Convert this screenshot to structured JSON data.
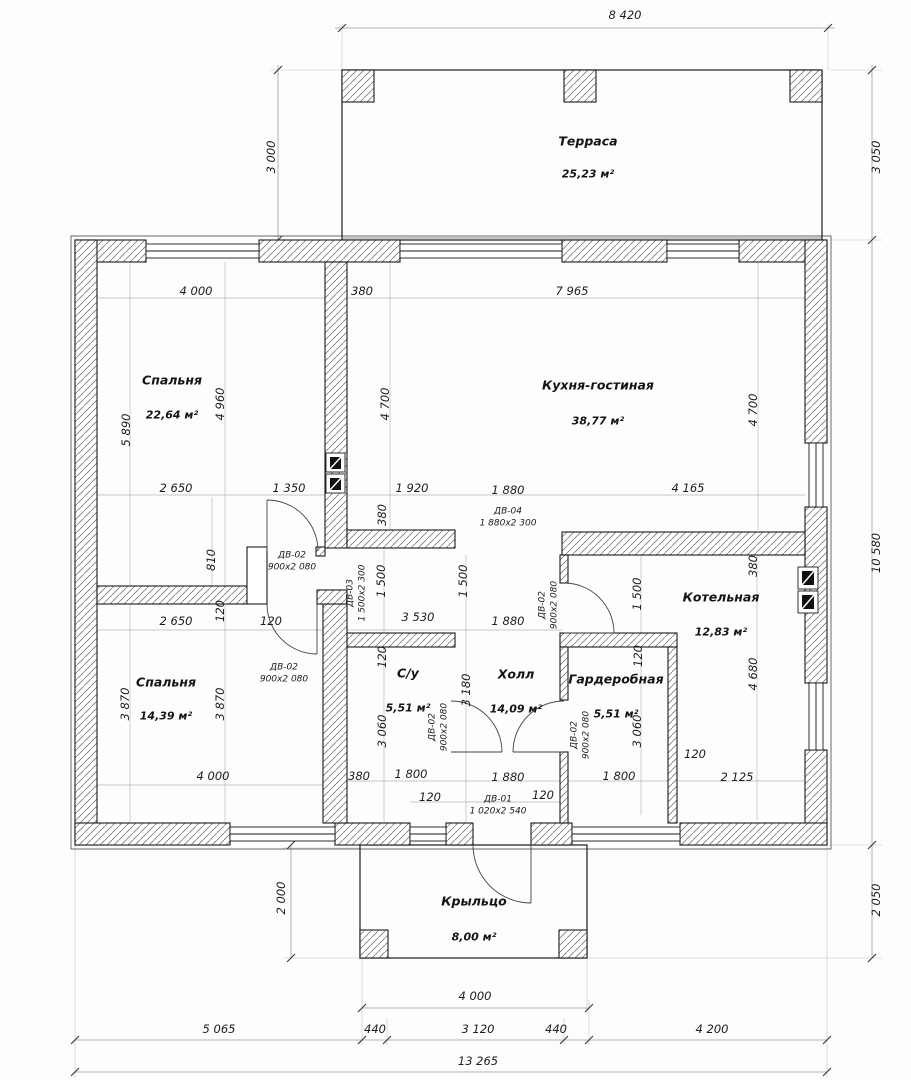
{
  "title": "Floor plan",
  "rooms": [
    {
      "id": "terrace",
      "name": "Терраса",
      "area": "25,23 м²",
      "x": 588,
      "ny": 141,
      "ay": 174
    },
    {
      "id": "bedroom-1",
      "name": "Спальня",
      "area": "22,64 м²",
      "x": 172,
      "ny": 380,
      "ay": 415
    },
    {
      "id": "kitchen",
      "name": "Кухня-гостиная",
      "area": "38,77 м²",
      "x": 598,
      "ny": 385,
      "ay": 421
    },
    {
      "id": "bedroom-2",
      "name": "Спальня",
      "area": "14,39 м²",
      "x": 166,
      "ny": 682,
      "ay": 716
    },
    {
      "id": "bathroom",
      "name": "С/у",
      "area": "5,51 м²",
      "x": 408,
      "ny": 673,
      "ay": 708
    },
    {
      "id": "hall",
      "name": "Холл",
      "area": "14,09 м²",
      "x": 516,
      "ny": 674,
      "ay": 709
    },
    {
      "id": "wardrobe",
      "name": "Гардеробная",
      "area": "5,51 м²",
      "x": 616,
      "ny": 679,
      "ay": 714
    },
    {
      "id": "boiler",
      "name": "Котельная",
      "area": "12,83 м²",
      "x": 721,
      "ny": 597,
      "ay": 632
    },
    {
      "id": "porch",
      "name": "Крыльцо",
      "area": "8,00 м²",
      "x": 474,
      "ny": 901,
      "ay": 937
    }
  ],
  "dims": [
    {
      "t": "8 420",
      "x": 625,
      "y": 15,
      "v": false
    },
    {
      "t": "3 050",
      "x": 876,
      "y": 157,
      "v": true
    },
    {
      "t": "3 000",
      "x": 271,
      "y": 157,
      "v": true
    },
    {
      "t": "10 580",
      "x": 876,
      "y": 553,
      "v": true
    },
    {
      "t": "2 050",
      "x": 876,
      "y": 900,
      "v": true
    },
    {
      "t": "2 000",
      "x": 281,
      "y": 898,
      "v": true
    },
    {
      "t": "4 000",
      "x": 475,
      "y": 996,
      "v": false
    },
    {
      "t": "5 065",
      "x": 219,
      "y": 1029,
      "v": false
    },
    {
      "t": "440",
      "x": 375,
      "y": 1029,
      "v": false
    },
    {
      "t": "3 120",
      "x": 478,
      "y": 1029,
      "v": false
    },
    {
      "t": "440",
      "x": 556,
      "y": 1029,
      "v": false
    },
    {
      "t": "4 200",
      "x": 712,
      "y": 1029,
      "v": false
    },
    {
      "t": "13 265",
      "x": 478,
      "y": 1061,
      "v": false
    },
    {
      "t": "4 000",
      "x": 196,
      "y": 291,
      "v": false
    },
    {
      "t": "380",
      "x": 362,
      "y": 291,
      "v": false
    },
    {
      "t": "7 965",
      "x": 572,
      "y": 291,
      "v": false
    },
    {
      "t": "5 890",
      "x": 126,
      "y": 430,
      "v": true
    },
    {
      "t": "4 960",
      "x": 220,
      "y": 404,
      "v": true
    },
    {
      "t": "4 700",
      "x": 385,
      "y": 404,
      "v": true
    },
    {
      "t": "4 700",
      "x": 753,
      "y": 410,
      "v": true
    },
    {
      "t": "2 650",
      "x": 176,
      "y": 488,
      "v": false
    },
    {
      "t": "1 350",
      "x": 289,
      "y": 488,
      "v": false
    },
    {
      "t": "1 920",
      "x": 412,
      "y": 488,
      "v": false
    },
    {
      "t": "1 880",
      "x": 508,
      "y": 490,
      "v": false
    },
    {
      "t": "4 165",
      "x": 688,
      "y": 488,
      "v": false
    },
    {
      "t": "810",
      "x": 211,
      "y": 560,
      "v": true
    },
    {
      "t": "380",
      "x": 382,
      "y": 515,
      "v": true
    },
    {
      "t": "1 500",
      "x": 381,
      "y": 581,
      "v": true
    },
    {
      "t": "1 500",
      "x": 463,
      "y": 581,
      "v": true
    },
    {
      "t": "1 500",
      "x": 637,
      "y": 594,
      "v": true
    },
    {
      "t": "380",
      "x": 753,
      "y": 566,
      "v": true
    },
    {
      "t": "2 650",
      "x": 176,
      "y": 621,
      "v": false
    },
    {
      "t": "120",
      "x": 220,
      "y": 611,
      "v": true
    },
    {
      "t": "120",
      "x": 271,
      "y": 621,
      "v": false
    },
    {
      "t": "3 530",
      "x": 418,
      "y": 617,
      "v": false
    },
    {
      "t": "1 880",
      "x": 508,
      "y": 621,
      "v": false
    },
    {
      "t": "120",
      "x": 382,
      "y": 657,
      "v": true
    },
    {
      "t": "120",
      "x": 638,
      "y": 656,
      "v": true
    },
    {
      "t": "3 870",
      "x": 125,
      "y": 704,
      "v": true
    },
    {
      "t": "3 870",
      "x": 220,
      "y": 704,
      "v": true
    },
    {
      "t": "3 060",
      "x": 382,
      "y": 731,
      "v": true
    },
    {
      "t": "3 180",
      "x": 466,
      "y": 690,
      "v": true
    },
    {
      "t": "3 060",
      "x": 637,
      "y": 731,
      "v": true
    },
    {
      "t": "4 680",
      "x": 753,
      "y": 674,
      "v": true
    },
    {
      "t": "4 000",
      "x": 213,
      "y": 776,
      "v": false
    },
    {
      "t": "380",
      "x": 359,
      "y": 776,
      "v": false
    },
    {
      "t": "1 800",
      "x": 411,
      "y": 774,
      "v": false
    },
    {
      "t": "1 880",
      "x": 508,
      "y": 777,
      "v": false
    },
    {
      "t": "1 800",
      "x": 619,
      "y": 776,
      "v": false
    },
    {
      "t": "120",
      "x": 695,
      "y": 754,
      "v": false
    },
    {
      "t": "2 125",
      "x": 737,
      "y": 777,
      "v": false
    },
    {
      "t": "120",
      "x": 430,
      "y": 797,
      "v": false
    },
    {
      "t": "120",
      "x": 543,
      "y": 795,
      "v": false
    }
  ],
  "door_labels": [
    {
      "code": "ДВ-04",
      "size": "1 880х2 300",
      "x": 508,
      "y": 518,
      "v": false
    },
    {
      "code": "ДВ-03",
      "size": "1 500х2 300",
      "x": 357,
      "y": 593,
      "v": true
    },
    {
      "code": "ДВ-02",
      "size": "900х2 080",
      "x": 292,
      "y": 562,
      "v": false
    },
    {
      "code": "ДВ-02",
      "size": "900х2 080",
      "x": 284,
      "y": 674,
      "v": false
    },
    {
      "code": "ДВ-02",
      "size": "900х2 080",
      "x": 549,
      "y": 605,
      "v": true
    },
    {
      "code": "ДВ-02",
      "size": "900х2 080",
      "x": 439,
      "y": 727,
      "v": true
    },
    {
      "code": "ДВ-02",
      "size": "900х2 080",
      "x": 581,
      "y": 735,
      "v": true
    },
    {
      "code": "ДВ-01",
      "size": "1 020х2 540",
      "x": 498,
      "y": 806,
      "v": false
    }
  ],
  "colors": {
    "wall_outline": "#1a1a1a",
    "hatch": "#7a7a7a",
    "dim_line": "#999999",
    "guide_line": "#b5b5b5",
    "paper": "#fdfdfc"
  }
}
